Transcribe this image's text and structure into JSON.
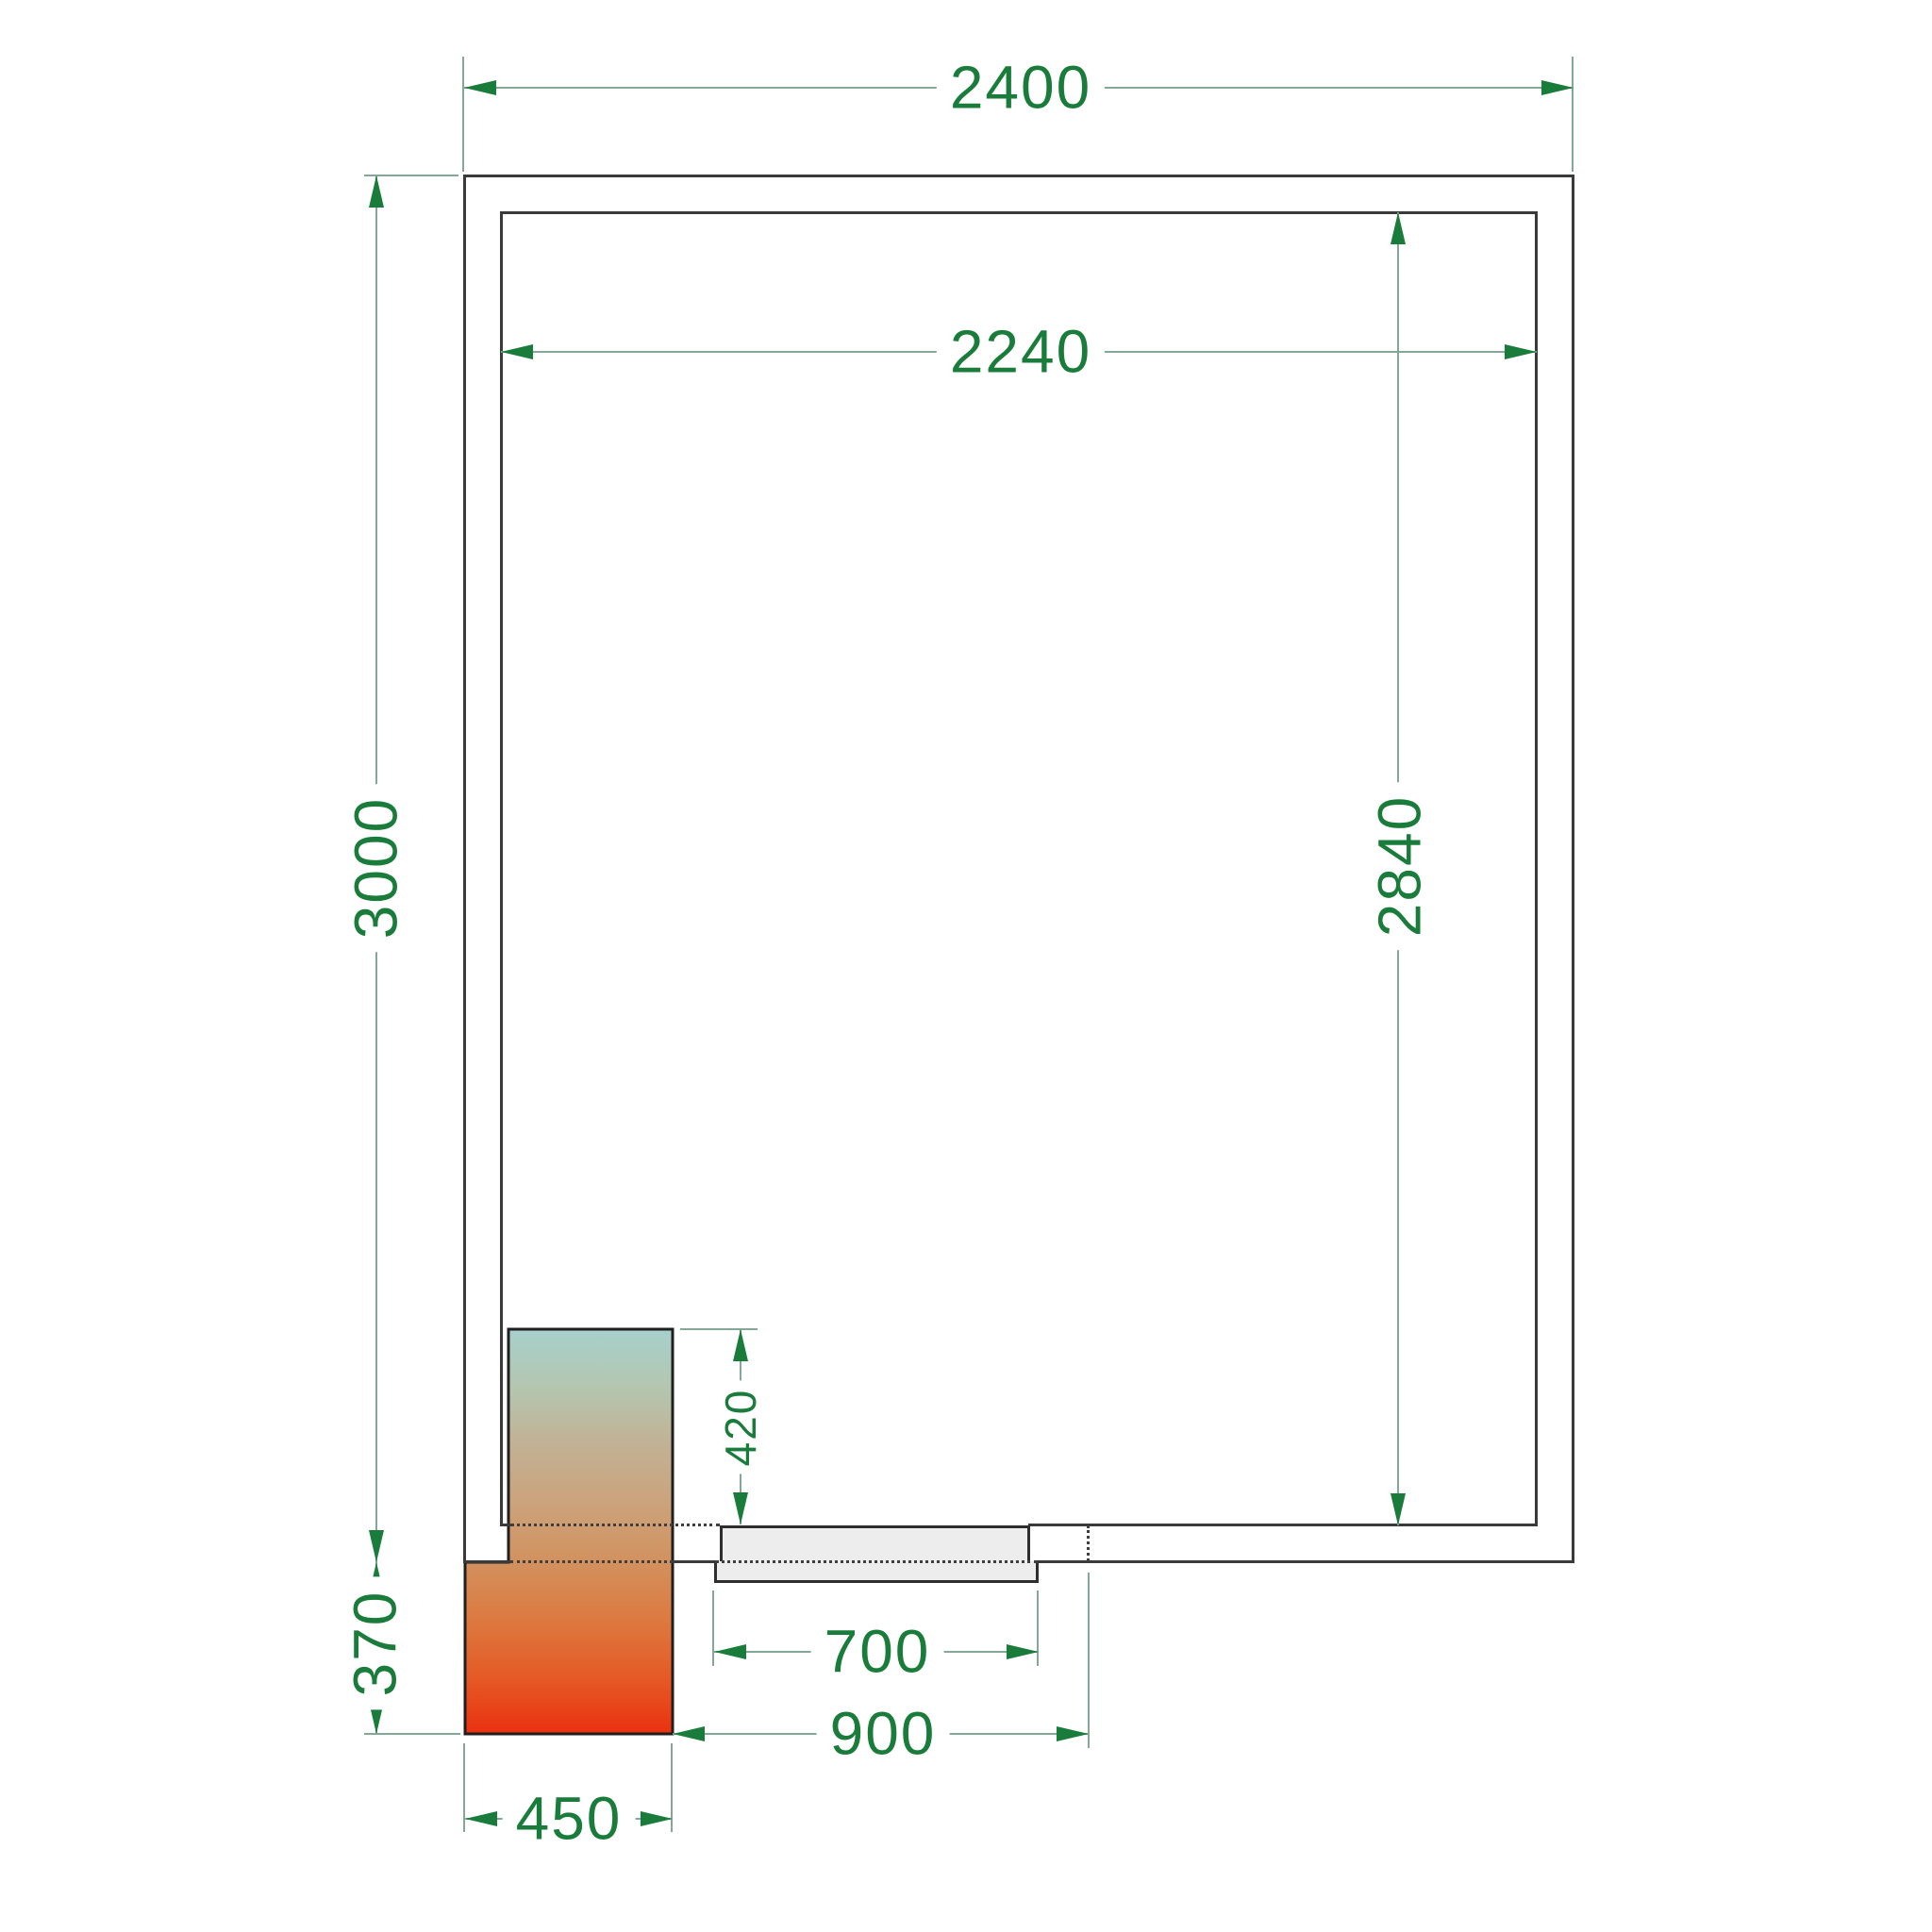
{
  "plan": {
    "dims": {
      "outer_width": "2400",
      "inner_width": "2240",
      "outer_depth": "3000",
      "inner_depth": "2840",
      "unit_inside_depth": "420",
      "unit_outside_depth": "370",
      "door_leaf_width": "700",
      "door_clearance_width": "900",
      "unit_outside_width": "450"
    },
    "colors": {
      "dimension_text": "#1a7c3a",
      "dimension_line": "#84a897",
      "wall_line": "#3a3a3a",
      "door_fill": "#ededed",
      "unit_gradient": [
        "#a6d0cc",
        "#b4c6b0",
        "#c2b194",
        "#cba37c",
        "#d2925f",
        "#dc7a41",
        "#e55b26",
        "#ea3110"
      ]
    }
  }
}
